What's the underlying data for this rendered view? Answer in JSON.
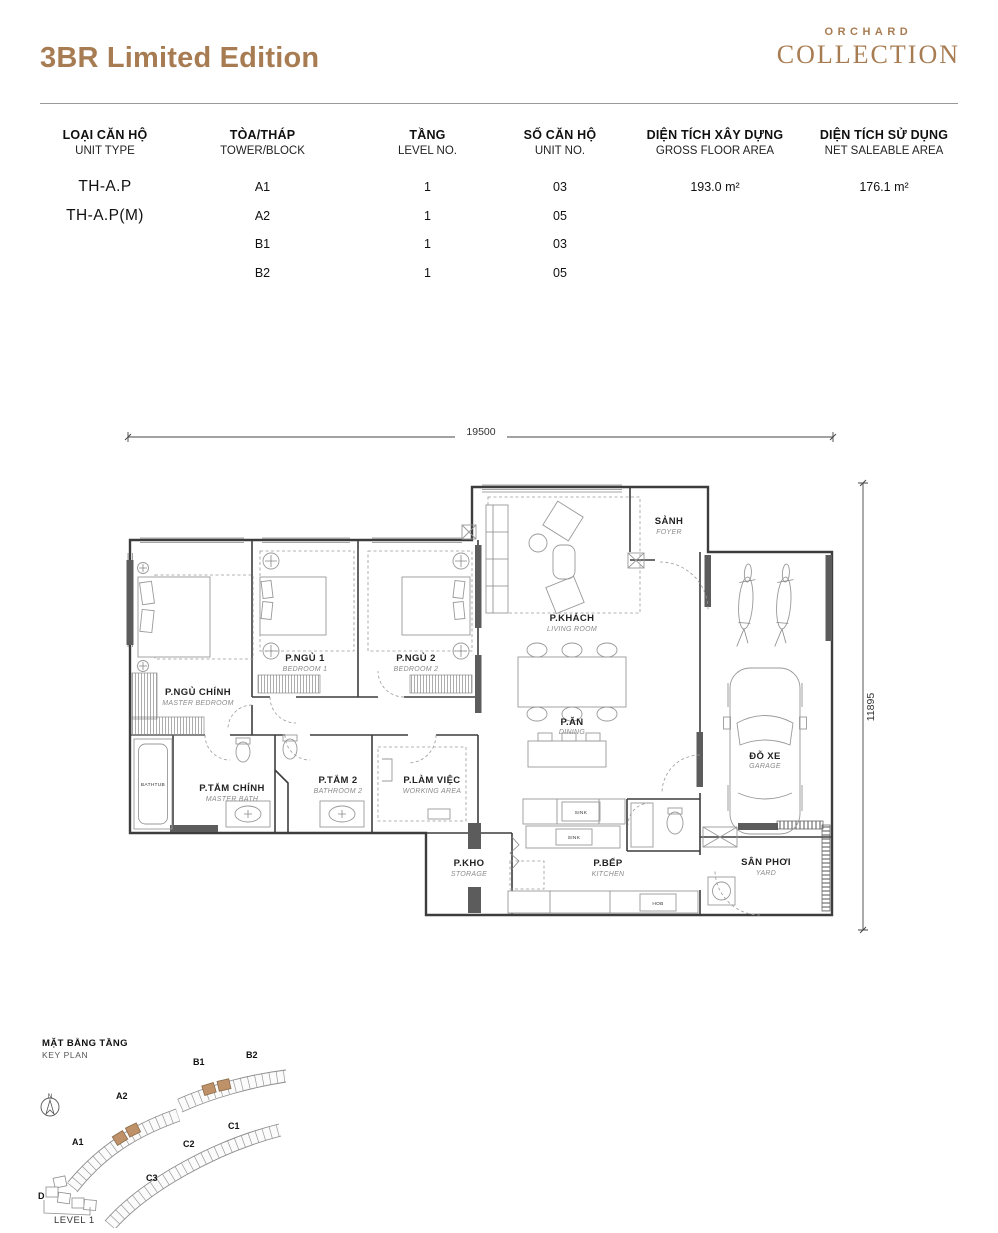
{
  "header": {
    "title": "3BR Limited Edition",
    "brand_top": "ORCHARD",
    "brand_bottom": "COLLECTION"
  },
  "colors": {
    "brand_brown": "#A87C52",
    "keyplan_highlight": "#BE9168",
    "wall_gray": "#3d3d3d"
  },
  "table": {
    "columns": [
      {
        "vi": "LOẠI CĂN HỘ",
        "en": "UNIT TYPE"
      },
      {
        "vi": "TÒA/THÁP",
        "en": "TOWER/BLOCK"
      },
      {
        "vi": "TẦNG",
        "en": "LEVEL NO."
      },
      {
        "vi": "SỐ CĂN HỘ",
        "en": "UNIT NO."
      },
      {
        "vi": "DIỆN TÍCH XÂY DỰNG",
        "en": "GROSS FLOOR AREA"
      },
      {
        "vi": "DIỆN TÍCH SỬ DỤNG",
        "en": "NET SALEABLE AREA"
      }
    ],
    "rows": [
      [
        "TH-A.P",
        "A1",
        "1",
        "03",
        "193.0 m²",
        "176.1 m²"
      ],
      [
        "TH-A.P(M)",
        "A2",
        "1",
        "05",
        "",
        ""
      ],
      [
        "",
        "B1",
        "1",
        "03",
        "",
        ""
      ],
      [
        "",
        "B2",
        "1",
        "05",
        "",
        ""
      ]
    ]
  },
  "plan": {
    "dims": {
      "width": "19500",
      "height": "11895"
    },
    "rooms": {
      "master": {
        "vi": "P.NGỦ CHÍNH",
        "en": "MASTER BEDROOM"
      },
      "bed1": {
        "vi": "P.NGỦ 1",
        "en": "BEDROOM 1"
      },
      "bed2": {
        "vi": "P.NGỦ 2",
        "en": "BEDROOM 2"
      },
      "living": {
        "vi": "P.KHÁCH",
        "en": "LIVING ROOM"
      },
      "dining": {
        "vi": "P.ĂN",
        "en": "DINING"
      },
      "foyer": {
        "vi": "SẢNH",
        "en": "FOYER"
      },
      "garage": {
        "vi": "ĐỖ XE",
        "en": "GARAGE"
      },
      "masterbath": {
        "vi": "P.TẮM CHÍNH",
        "en": "MASTER BATH"
      },
      "bath2": {
        "vi": "P.TẮM 2",
        "en": "BATHROOM 2"
      },
      "working": {
        "vi": "P.LÀM VIỆC",
        "en": "WORKING AREA"
      },
      "storage": {
        "vi": "P.KHO",
        "en": "STORAGE"
      },
      "kitchen": {
        "vi": "P.BẾP",
        "en": "KITCHEN"
      },
      "yard": {
        "vi": "SÂN PHƠI",
        "en": "YARD"
      }
    },
    "fixtures": {
      "bathtub": "BATHTUB",
      "sink": "SINK",
      "hob": "HOB"
    }
  },
  "keyplan": {
    "title_vi": "MẶT BẰNG TẦNG",
    "title_en": "KEY PLAN",
    "north": "N",
    "level": "LEVEL 1",
    "blocks": [
      "A1",
      "A2",
      "B1",
      "B2",
      "C1",
      "C2",
      "C3",
      "D"
    ]
  }
}
